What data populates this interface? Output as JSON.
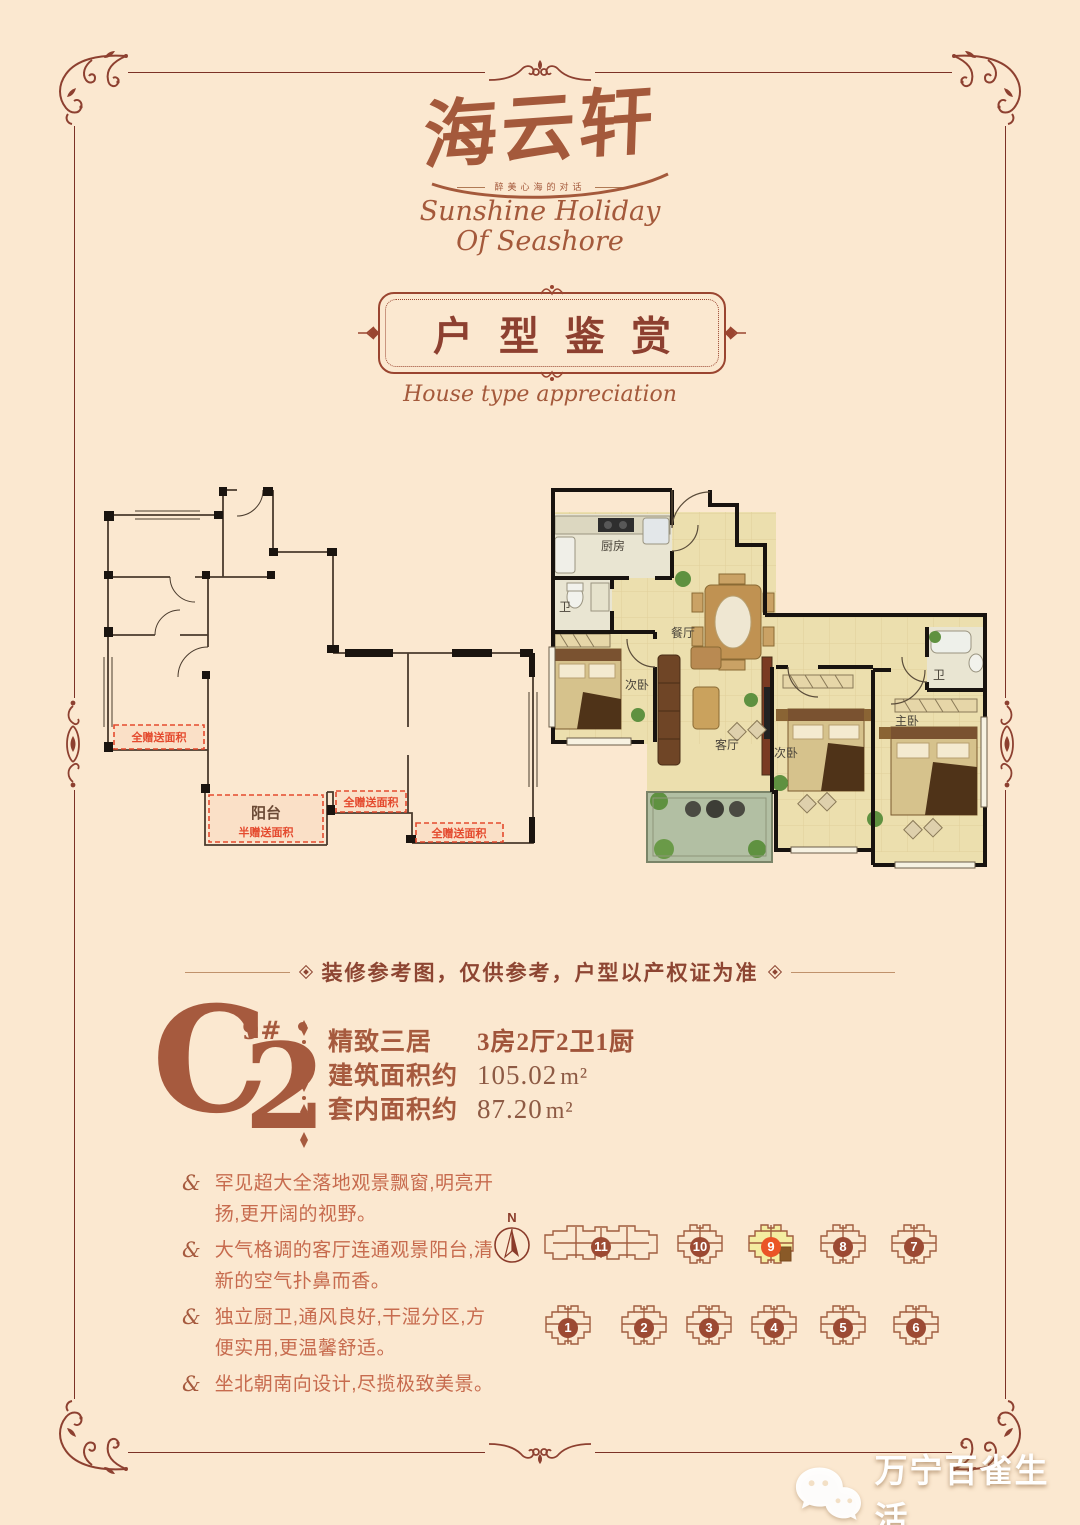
{
  "colors": {
    "background": "#fbe8d0",
    "frame": "#7b3226",
    "accent": "#a4593b",
    "gift_red": "#e44a2e",
    "badge": "#9c4a33",
    "badge_highlight": "#ea5426"
  },
  "brand": {
    "title": "海云轩",
    "tagline": "醉美心海的对话",
    "subtitle_line1": "Sunshine Holiday",
    "subtitle_line2": "Of Seashore"
  },
  "banner": {
    "title": "户型鉴赏",
    "subtitle": "House type appreciation"
  },
  "plans": {
    "outline": {
      "gift_full": "全赠送面积",
      "gift_half": "半赠送面积",
      "balcony": "阳台"
    },
    "furnished": {
      "kitchen": "厨房",
      "bath": "卫",
      "dining": "餐厅",
      "secondary_bedroom": "次卧",
      "living": "客厅",
      "master_bedroom": "主卧"
    }
  },
  "disclaimer": {
    "text": "装修参考图，仅供参考，户型以产权证为准"
  },
  "unit": {
    "code_letter": "C",
    "code_digit": "2",
    "building_no": "9#",
    "specs": [
      {
        "label": "精致三居",
        "value": "3房2厅2卫1厨",
        "unit": ""
      },
      {
        "label": "建筑面积约",
        "value": "105.02",
        "unit": "m²"
      },
      {
        "label": "套内面积约",
        "value": "87.20",
        "unit": "m²"
      }
    ]
  },
  "features": {
    "bullet": "&",
    "items": [
      "罕见超大全落地观景飘窗,明亮开扬,更开阔的视野。",
      "大气格调的客厅连通观景阳台,清新的空气扑鼻而香。",
      "独立厨卫,通风良好,干湿分区,方便实用,更温馨舒适。",
      "坐北朝南向设计,尽揽极致美景。"
    ]
  },
  "siteplan": {
    "north": "N",
    "row1": [
      "11",
      "10",
      "9",
      "8",
      "7"
    ],
    "row2": [
      "1",
      "2",
      "3",
      "4",
      "5",
      "6"
    ],
    "highlighted_building": "9"
  },
  "watermark": {
    "text": "万宁百雀生活"
  }
}
